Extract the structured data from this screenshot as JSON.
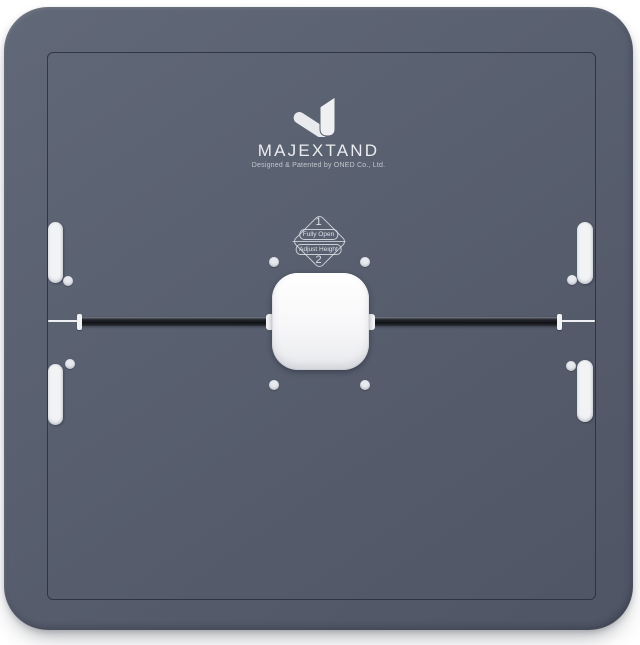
{
  "product": {
    "brand": "MAJEXTAND",
    "tagline": "Designed & Patented by ONED Co., Ltd.",
    "badge": {
      "step1_number": "1",
      "step1_label": "Fully Open",
      "step2_label": "Adjust Height",
      "step2_number": "2"
    },
    "icons": {
      "logo": "majextand-check-logo"
    },
    "colors": {
      "background": "#ffffff",
      "plate": "#59606f",
      "plate_seam_line": "#323845",
      "slot_bar_dark": "#17191e",
      "white_parts": "#f2f3f5",
      "brand_text": "#eaecef",
      "badge_line": "#dde1e6"
    }
  }
}
